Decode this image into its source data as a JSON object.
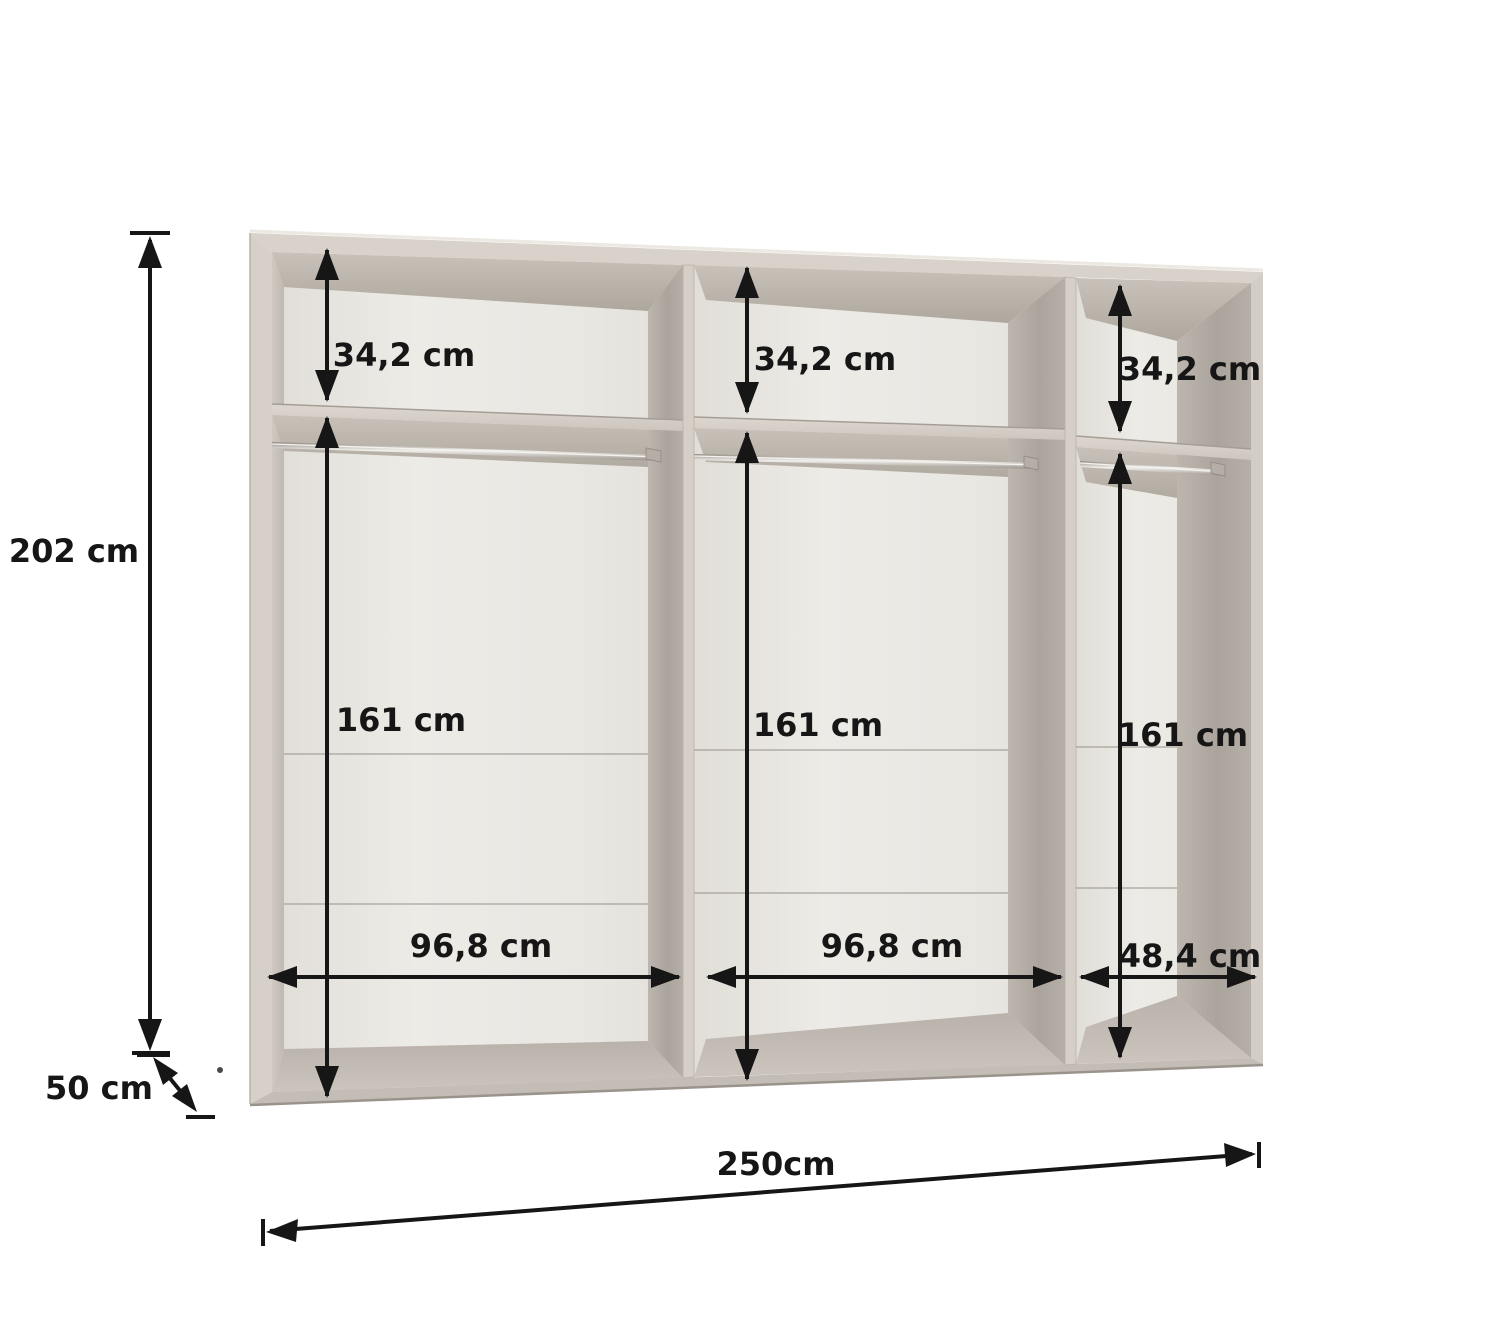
{
  "dimensions": {
    "total_height": "202 cm",
    "total_depth": "50 cm",
    "total_width": "250cm",
    "sections": [
      {
        "position": "left",
        "top_compartment_height": "34,2 cm",
        "hanging_area_height": "161 cm",
        "inner_width": "96,8 cm"
      },
      {
        "position": "middle",
        "top_compartment_height": "34,2 cm",
        "hanging_area_height": "161 cm",
        "inner_width": "96,8 cm"
      },
      {
        "position": "right",
        "top_compartment_height": "34,2 cm",
        "hanging_area_height": "161 cm",
        "inner_width": "48,4 cm"
      }
    ]
  },
  "colors": {
    "background": "#ffffff",
    "carcass_front": "#d6d0c8",
    "interior_back_wall": "#eae8e3",
    "interior_shadow": "#b2aba3",
    "rail_metal": "#e8e5e0",
    "dimension_ink": "#161616"
  }
}
